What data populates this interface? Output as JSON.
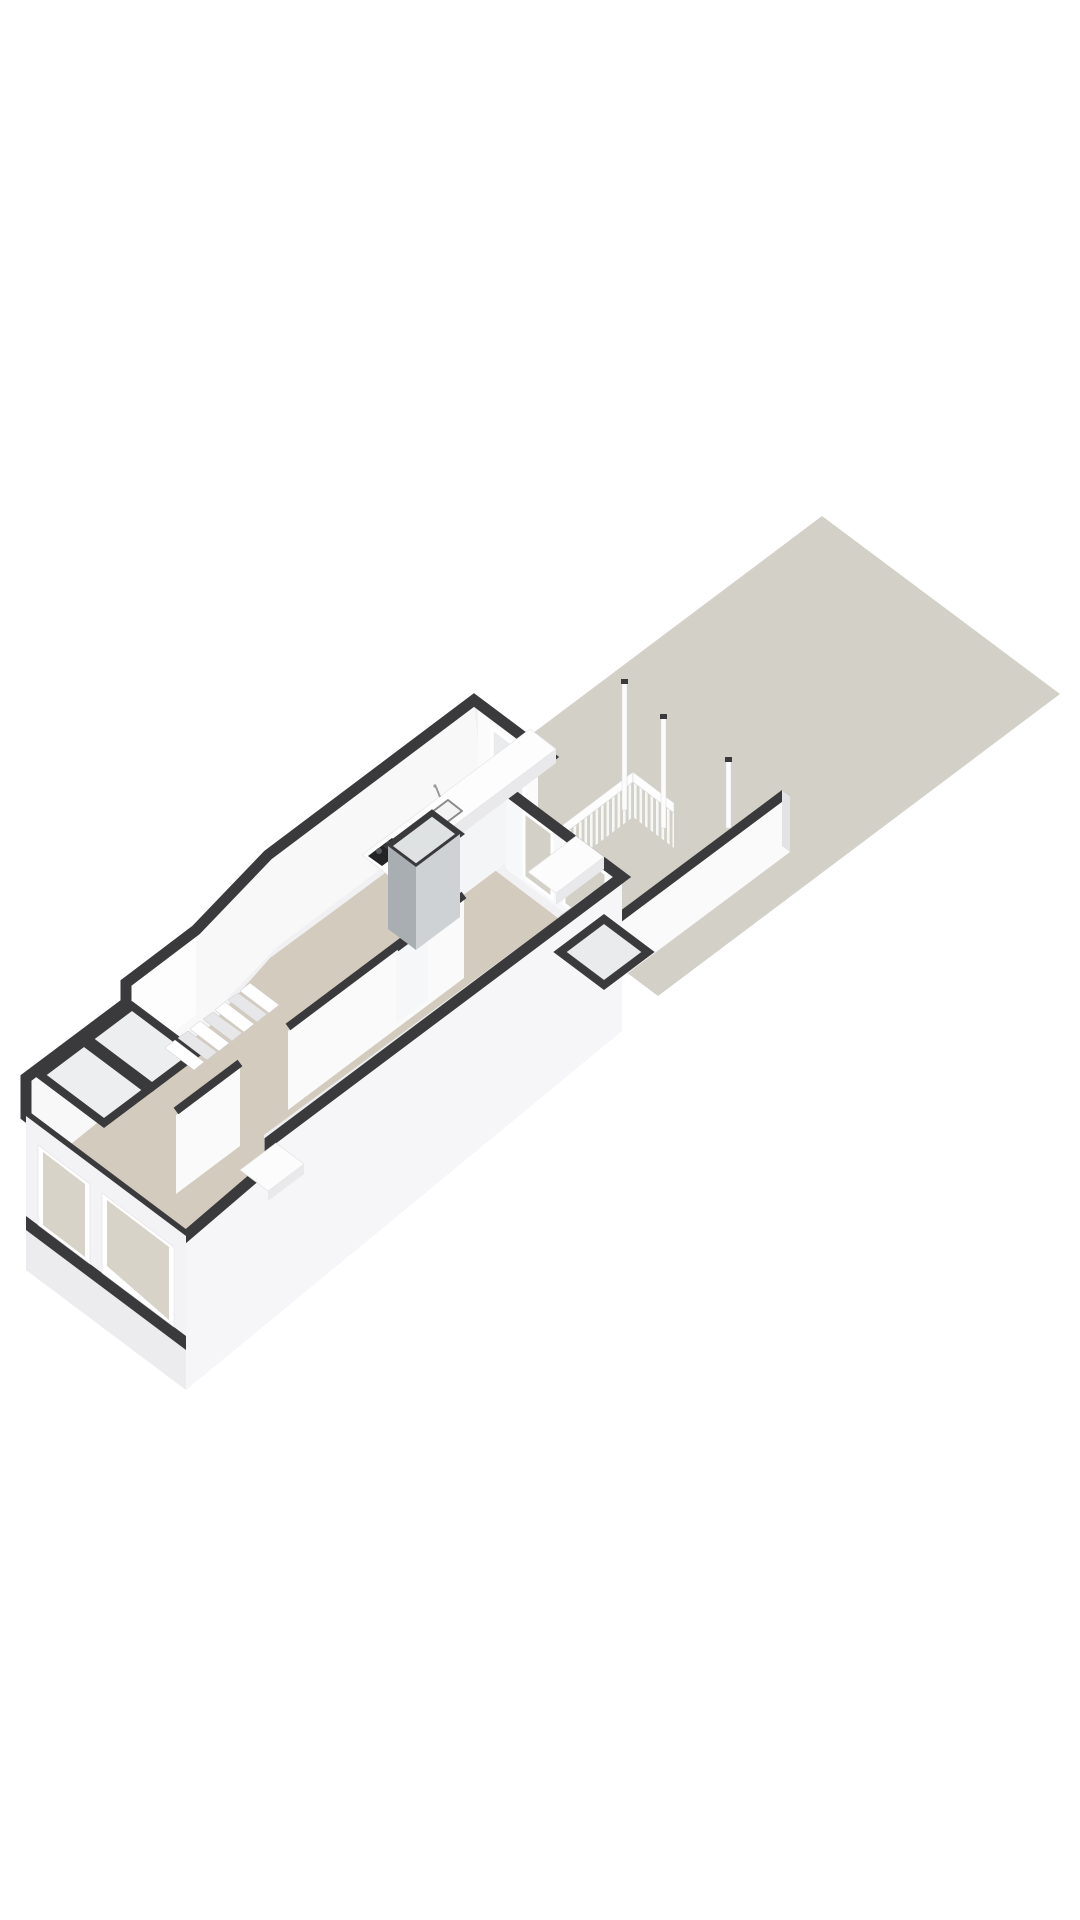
{
  "scene": {
    "description": "3D axonometric floor plan of a ground-floor apartment with rear garden, porch railing and posts",
    "canvas": {
      "width": 1080,
      "height": 1920,
      "background": "#ffffff"
    },
    "colors": {
      "garden": "#d3d0c7",
      "floor": "#d3cbbd",
      "dark": "#3a3a3c",
      "mass": "#f1f1f3",
      "faceWhite": "#f8f8f9",
      "faceBright": "#fbfbfc",
      "faceMid": "#edeef0",
      "faceShade": "#e3e3e5",
      "extWall": "#f6f6f8",
      "glass": "#d8d3c8",
      "winGray": "#e9ebec",
      "chimneyDark": "#a8aeb1",
      "chimneyLight": "#ced2d4",
      "stove": "#242426",
      "railWhite": "#fdfdfd"
    },
    "shapes": [
      {
        "name": "garden-plot",
        "el": "polygon",
        "attrs": {
          "points": "822,516 1060,694 658,996 420,818",
          "fill": "$garden"
        }
      },
      {
        "name": "garden-wall-top",
        "el": "polygon",
        "attrs": {
          "points": "608,920 782,790 790,796 616,926",
          "fill": "$dark"
        }
      },
      {
        "name": "garden-wall-face",
        "el": "polygon",
        "attrs": {
          "points": "616,926 790,796 790,852 616,982",
          "fill": "#fafafa"
        }
      },
      {
        "name": "garden-wall-end",
        "el": "polygon",
        "attrs": {
          "points": "782,790 790,796 790,852 782,846",
          "fill": "$faceShade"
        }
      },
      {
        "name": "porch-railing-balusters-left",
        "el": "polygon",
        "attrs": {
          "points": "556,839 633,781 633,817 556,875",
          "fill": "url(#bal)"
        }
      },
      {
        "name": "porch-railing-toprail-left",
        "el": "polygon",
        "attrs": {
          "points": "556,830 633,772 633,782 556,840",
          "fill": "$railWhite",
          "stroke": "#d8d8d8",
          "stroke-width": "0.6"
        }
      },
      {
        "name": "porch-railing-balusters-right",
        "el": "polygon",
        "attrs": {
          "points": "633,781 674,812 674,848 633,817",
          "fill": "url(#bal)"
        }
      },
      {
        "name": "porch-railing-toprail-right",
        "el": "polygon",
        "attrs": {
          "points": "633,772 674,803 674,813 633,782",
          "fill": "$railWhite",
          "stroke": "#d8d8d8",
          "stroke-width": "0.6"
        }
      },
      {
        "name": "porch-post-1",
        "el": "rect",
        "attrs": {
          "x": "622",
          "y": "682",
          "width": "5",
          "height": "128",
          "fill": "#fcfcfc",
          "stroke": "#d8d8d8",
          "stroke-width": "0.5"
        }
      },
      {
        "name": "porch-post-1-cap",
        "el": "rect",
        "attrs": {
          "x": "621",
          "y": "679",
          "width": "7",
          "height": "5",
          "fill": "$dark"
        }
      },
      {
        "name": "porch-post-2",
        "el": "rect",
        "attrs": {
          "x": "661",
          "y": "717",
          "width": "5",
          "height": "111",
          "fill": "#fcfcfc",
          "stroke": "#d8d8d8",
          "stroke-width": "0.5"
        }
      },
      {
        "name": "porch-post-2-cap",
        "el": "rect",
        "attrs": {
          "x": "660",
          "y": "714",
          "width": "7",
          "height": "5",
          "fill": "$dark"
        }
      },
      {
        "name": "porch-post-3",
        "el": "rect",
        "attrs": {
          "x": "726",
          "y": "760",
          "width": "5",
          "height": "68",
          "fill": "#fcfcfc",
          "stroke": "#d8d8d8",
          "stroke-width": "0.5"
        }
      },
      {
        "name": "porch-post-3-cap",
        "el": "rect",
        "attrs": {
          "x": "725",
          "y": "757",
          "width": "7",
          "height": "5",
          "fill": "$dark"
        }
      },
      {
        "name": "building-mass",
        "el": "path",
        "attrs": {
          "d": "M474,700 L550,757 L506,790 L622,877 L622,1031 L186,1390 L26,1270 L26,1078 L126,1003 L126,983 L196,930 L268,855 Z",
          "fill": "$mass"
        }
      },
      {
        "name": "interior-floor",
        "el": "polygon",
        "attrs": {
          "points": "484,800 528,841 492,868 600,950 196,1254 50,1144 140,1078 210,1026 270,958",
          "fill": "$floor"
        }
      },
      {
        "name": "left-wall-interior-face-a",
        "el": "polygon",
        "attrs": {
          "points": "474,706 268,861 278,946 484,791",
          "fill": "$faceWhite"
        }
      },
      {
        "name": "left-wall-interior-face-b",
        "el": "polygon",
        "attrs": {
          "points": "268,861 196,936 210,1016 278,946",
          "fill": "$faceWhite"
        }
      },
      {
        "name": "left-wall-interior-face-c",
        "el": "polygon",
        "attrs": {
          "points": "196,936 126,989 140,1068 210,1016",
          "fill": "$faceWhite"
        }
      },
      {
        "name": "left-wall-interior-face-d",
        "el": "polygon",
        "attrs": {
          "points": "126,989 126,1009 140,1088 140,1068",
          "fill": "$faceWhite"
        }
      },
      {
        "name": "left-wall-interior-face-e",
        "el": "polygon",
        "attrs": {
          "points": "126,1009 26,1085 44,1166 140,1088",
          "fill": "$faceWhite"
        }
      },
      {
        "name": "kitchen-rear-wall-face",
        "el": "polygon",
        "attrs": {
          "points": "478,710 538,755 538,830 478,785",
          "fill": "$faceBright"
        }
      },
      {
        "name": "kitchen-rear-window",
        "el": "polygon",
        "attrs": {
          "points": "492,728 524,752 524,800 492,776",
          "fill": "$winGray",
          "stroke": "#ffffff",
          "stroke-width": "3.5"
        }
      },
      {
        "name": "kitchen-right-wall-face",
        "el": "polygon",
        "attrs": {
          "points": "438,841 506,790 506,863 438,914",
          "fill": "#f4f5f6"
        }
      },
      {
        "name": "kitchen-right-wall-top",
        "el": "line",
        "attrs": {
          "x1": "438",
          "y1": "841",
          "x2": "506",
          "y2": "790",
          "stroke": "$dark",
          "stroke-width": "8"
        }
      },
      {
        "name": "rear-room-wall-face",
        "el": "polygon",
        "attrs": {
          "points": "506,798 622,885 622,956 506,869",
          "fill": "#f7f8f9"
        }
      },
      {
        "name": "rear-room-glass-door-1",
        "el": "polygon",
        "attrs": {
          "points": "524,812 552,833 552,898 524,877",
          "fill": "$garden",
          "stroke": "#ffffff",
          "stroke-width": "3"
        }
      },
      {
        "name": "rear-room-glass-door-2",
        "el": "polygon",
        "attrs": {
          "points": "564,842 606,874 606,936 564,904",
          "fill": "$garden",
          "stroke": "#ffffff",
          "stroke-width": "3"
        }
      },
      {
        "name": "right-wall-interior-face",
        "el": "polygon",
        "attrs": {
          "points": "264,1135 610,880 610,958 264,1213",
          "fill": "$faceMid"
        }
      },
      {
        "name": "right-wall-door",
        "el": "polygon",
        "attrs": {
          "points": "560,916 592,892 592,952 560,976",
          "fill": "#ffffff",
          "stroke": "#d8d8d8",
          "stroke-width": "0.8"
        }
      },
      {
        "name": "chamfer-exterior-face",
        "el": "polygon",
        "attrs": {
          "points": "126,983 196,930 196,1015 126,1068",
          "fill": "#fdfdfd"
        }
      },
      {
        "name": "right-wall-exterior-face",
        "el": "polygon",
        "attrs": {
          "points": "186,1236 270,1164 270,1141 622,877 622,1031 186,1390",
          "fill": "$extWall"
        }
      },
      {
        "name": "parapet-band",
        "el": "path",
        "attrs": {
          "d": "M474,700 L550,757 L506,790 L622,877 L270,1141 L270,1164 L186,1236 L26,1116 L26,1078 L126,1003 L126,983 L196,930 L268,855 Z",
          "fill": "none",
          "stroke": "$dark",
          "stroke-width": "11",
          "stroke-linejoin": "miter"
        }
      },
      {
        "name": "hall-partition-face-front",
        "el": "polygon",
        "attrs": {
          "points": "176,1115 240,1067 240,1146 176,1194",
          "fill": "#fafafa"
        }
      },
      {
        "name": "hall-partition-top-front",
        "el": "line",
        "attrs": {
          "x1": "176",
          "y1": "1111",
          "x2": "240",
          "y2": "1063",
          "stroke": "$dark",
          "stroke-width": "8"
        }
      },
      {
        "name": "hall-partition-face-rear",
        "el": "polygon",
        "attrs": {
          "points": "288,1031 464,899 464,978 288,1110",
          "fill": "#fafafa"
        }
      },
      {
        "name": "hall-partition-top-rear",
        "el": "line",
        "attrs": {
          "x1": "288",
          "y1": "1027",
          "x2": "464",
          "y2": "895",
          "stroke": "$dark",
          "stroke-width": "8"
        }
      },
      {
        "name": "cross-wall-stub-face",
        "el": "polygon",
        "attrs": {
          "points": "396,952 428,928 428,1000 396,1024",
          "fill": "#f6f7f8"
        }
      },
      {
        "name": "cross-wall-stub-top",
        "el": "line",
        "attrs": {
          "x1": "396",
          "y1": "948",
          "x2": "428",
          "y2": "924",
          "stroke": "$dark",
          "stroke-width": "8"
        }
      },
      {
        "name": "closet-block",
        "el": "polygon",
        "attrs": {
          "points": "560,952 604,919 648,952 604,985",
          "fill": "$winGray",
          "stroke": "$dark",
          "stroke-width": "8",
          "stroke-linejoin": "miter"
        }
      },
      {
        "name": "toilet-room-rear",
        "el": "polygon",
        "attrs": {
          "points": "88,1039 132,1006 196,1054 152,1087",
          "fill": "#eceef0",
          "stroke": "$dark",
          "stroke-width": "8",
          "stroke-linejoin": "miter"
        }
      },
      {
        "name": "toilet-room-front",
        "el": "polygon",
        "attrs": {
          "points": "40,1075 84,1042 148,1090 104,1123",
          "fill": "#eceef0",
          "stroke": "$dark",
          "stroke-width": "8",
          "stroke-linejoin": "miter"
        }
      },
      {
        "name": "stair-tread-1",
        "el": "polygon",
        "attrs": {
          "points": "165,1048 175,1040 204,1062 194,1070",
          "fill": "#ffffff",
          "stroke": "#cccccf",
          "stroke-width": "0.5"
        }
      },
      {
        "name": "stair-tread-2",
        "el": "polygon",
        "attrs": {
          "points": "178,1038 188,1031 217,1052 207,1060",
          "fill": "#e7e7e9",
          "stroke": "#cccccf",
          "stroke-width": "0.5"
        }
      },
      {
        "name": "stair-tread-3",
        "el": "polygon",
        "attrs": {
          "points": "190,1029 200,1021 229,1043 219,1051",
          "fill": "#ffffff",
          "stroke": "#cccccf",
          "stroke-width": "0.5"
        }
      },
      {
        "name": "stair-tread-4",
        "el": "polygon",
        "attrs": {
          "points": "203,1019 213,1012 242,1033 232,1041",
          "fill": "#e7e7e9",
          "stroke": "#cccccf",
          "stroke-width": "0.5"
        }
      },
      {
        "name": "stair-tread-5",
        "el": "polygon",
        "attrs": {
          "points": "215,1010 225,1002 254,1024 244,1032",
          "fill": "#ffffff",
          "stroke": "#cccccf",
          "stroke-width": "0.5"
        }
      },
      {
        "name": "stair-tread-6",
        "el": "polygon",
        "attrs": {
          "points": "228,1000 238,993 267,1014 257,1022",
          "fill": "#e7e7e9",
          "stroke": "#cccccf",
          "stroke-width": "0.5"
        }
      },
      {
        "name": "stair-tread-7",
        "el": "polygon",
        "attrs": {
          "points": "240,991 250,983 279,1005 269,1013",
          "fill": "#ffffff",
          "stroke": "#cccccf",
          "stroke-width": "0.5"
        }
      },
      {
        "name": "kitchen-counter-top",
        "el": "polygon",
        "attrs": {
          "points": "362,855 530,729 556,749 388,875",
          "fill": "#fdfdfd",
          "stroke": "#e3e3e3",
          "stroke-width": "0.6"
        }
      },
      {
        "name": "kitchen-counter-face",
        "el": "polygon",
        "attrs": {
          "points": "388,875 556,749 556,763 388,889",
          "fill": "#e9e9eb"
        }
      },
      {
        "name": "stove-cooktop",
        "el": "polygon",
        "attrs": {
          "points": "368,856 392,838 406,848 382,866",
          "fill": "$stove"
        }
      },
      {
        "name": "stove-burner-1",
        "el": "circle",
        "attrs": {
          "cx": "379",
          "cy": "851",
          "r": "3",
          "fill": "#55585a"
        }
      },
      {
        "name": "stove-burner-2",
        "el": "circle",
        "attrs": {
          "cx": "389",
          "cy": "844",
          "r": "3",
          "fill": "#55585a"
        }
      },
      {
        "name": "stove-burner-3",
        "el": "circle",
        "attrs": {
          "cx": "391",
          "cy": "859",
          "r": "3",
          "fill": "#55585a"
        }
      },
      {
        "name": "stove-burner-4",
        "el": "circle",
        "attrs": {
          "cx": "401",
          "cy": "852",
          "r": "3",
          "fill": "#55585a"
        }
      },
      {
        "name": "kitchen-sink",
        "el": "polygon",
        "attrs": {
          "points": "432,812 448,800 462,811 446,823",
          "fill": "#f4f4f4",
          "stroke": "#8a8a8a",
          "stroke-width": "2",
          "stroke-linejoin": "round"
        }
      },
      {
        "name": "kitchen-faucet",
        "el": "line",
        "attrs": {
          "x1": "440",
          "y1": "797",
          "x2": "436",
          "y2": "787",
          "stroke": "#9a9a9a",
          "stroke-width": "2"
        }
      },
      {
        "name": "kitchen-faucet-head",
        "el": "circle",
        "attrs": {
          "cx": "435",
          "cy": "786",
          "r": "1.6",
          "fill": "#9a9a9a"
        }
      },
      {
        "name": "chimney-top",
        "el": "polygon",
        "attrs": {
          "points": "388,846 432,813 460,834 416,867",
          "fill": "#dfe2e3",
          "stroke": "$dark",
          "stroke-width": "6",
          "stroke-linejoin": "miter"
        }
      },
      {
        "name": "chimney-face-left",
        "el": "polygon",
        "attrs": {
          "points": "388,846 416,867 416,950 388,929",
          "fill": "$chimneyDark"
        }
      },
      {
        "name": "chimney-face-right",
        "el": "polygon",
        "attrs": {
          "points": "416,867 460,834 460,917 416,950",
          "fill": "$chimneyLight"
        }
      },
      {
        "name": "sideboard-top",
        "el": "polygon",
        "attrs": {
          "points": "528,872 576,836 604,857 556,893",
          "fill": "#fcfcfc",
          "stroke": "#e0e0e0",
          "stroke-width": "0.6"
        }
      },
      {
        "name": "sideboard-face",
        "el": "polygon",
        "attrs": {
          "points": "556,893 604,857 604,869 556,905",
          "fill": "#e9e9eb"
        }
      },
      {
        "name": "front-room-table-top",
        "el": "polygon",
        "attrs": {
          "points": "240,1170 276,1143 304,1164 268,1191",
          "fill": "#fcfcfc",
          "stroke": "#e0e0e0",
          "stroke-width": "0.6"
        }
      },
      {
        "name": "front-room-table-face",
        "el": "polygon",
        "attrs": {
          "points": "268,1191 304,1164 304,1174 268,1201",
          "fill": "#e9e9eb"
        }
      },
      {
        "name": "facade-face",
        "el": "polygon",
        "attrs": {
          "points": "26,1116 186,1236 186,1390 26,1270",
          "fill": "#f3f3f5"
        }
      },
      {
        "name": "facade-lower-face",
        "el": "polygon",
        "attrs": {
          "points": "26,1230 186,1350 186,1390 26,1270",
          "fill": "#ececef"
        }
      },
      {
        "name": "facade-slab-band",
        "el": "polygon",
        "attrs": {
          "points": "26,1216 186,1336 186,1350 26,1230",
          "fill": "$dark"
        }
      },
      {
        "name": "facade-window-1-frame",
        "el": "polygon",
        "attrs": {
          "points": "38,1145 90,1184 90,1264 38,1225",
          "fill": "#ffffff",
          "stroke": "#e0e0e2",
          "stroke-width": "0.6"
        }
      },
      {
        "name": "facade-window-1-glass",
        "el": "polygon",
        "attrs": {
          "points": "43,1152 85,1184 85,1257 43,1225",
          "fill": "$glass"
        }
      },
      {
        "name": "facade-window-2-frame",
        "el": "polygon",
        "attrs": {
          "points": "102,1193 174,1247 174,1327 102,1273",
          "fill": "#ffffff",
          "stroke": "#e0e0e2",
          "stroke-width": "0.6"
        }
      },
      {
        "name": "facade-window-2-glass",
        "el": "polygon",
        "attrs": {
          "points": "107,1200 169,1247 169,1320 107,1266",
          "fill": "$glass"
        }
      }
    ]
  }
}
